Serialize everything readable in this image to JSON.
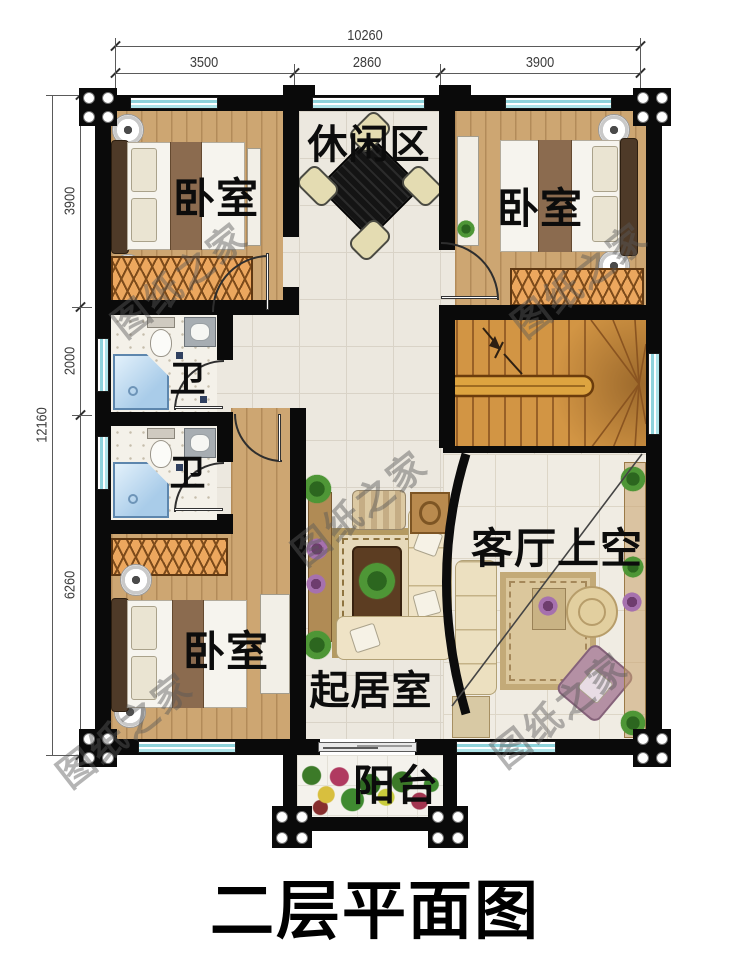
{
  "title": "二层平面图",
  "watermark": "图纸之家",
  "dimensions": {
    "top_total": "10260",
    "top_segments": [
      "3500",
      "2860",
      "3900"
    ],
    "left_total": "12160",
    "left_segments": [
      "3900",
      "2000",
      "6260"
    ]
  },
  "rooms": {
    "leisure": "休闲区",
    "bedroom_top_left": "卧室",
    "bedroom_top_right": "卧室",
    "bath_upper": "卫",
    "bath_lower": "卫",
    "living_void": "客厅上空",
    "bedroom_bottom_left": "卧室",
    "sitting": "起居室",
    "balcony": "阳台"
  },
  "colors": {
    "wall": "#0a0a0a",
    "window": "#8ed3db",
    "wood_floor": "#cda672",
    "stair_wood": "#d29544",
    "hall_tile": "#ece8df"
  }
}
